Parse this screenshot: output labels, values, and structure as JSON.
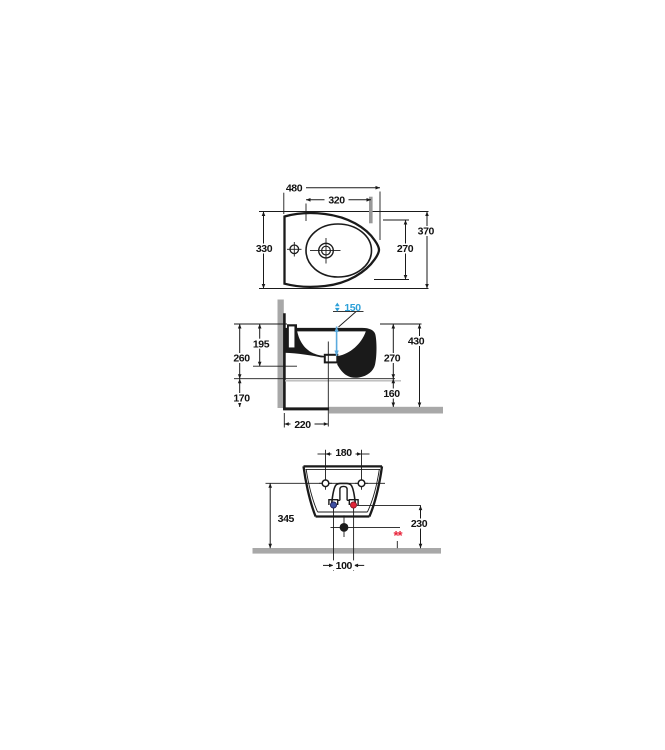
{
  "title": "Wall-hung bidet technical drawing (three views with dimensions in mm)",
  "colors": {
    "line": "#1a1a1a",
    "wall_floor_gray": "#a8a8a8",
    "plan_marker_gray": "#999999",
    "jet_text_blue": "#2da0d8",
    "jet_arrow_blue": "#5aaade",
    "cold_water_blue": "#3d4fa1",
    "hot_water_red": "#e02537",
    "note_red": "#e8233a"
  },
  "top_view": {
    "overall_length": "480",
    "bowl_length": "320",
    "overall_depth": "370",
    "bowl_width": "270",
    "rear_width": "330"
  },
  "side_view": {
    "jet_height": "150",
    "rim_to_underside": "195",
    "rim_to_belly": "260",
    "belly_to_floor": "170",
    "overall_height": "430",
    "front_height": "270",
    "front_clearance": "160",
    "drain_from_wall": "220"
  },
  "front_view": {
    "fixing_hole_spacing": "180",
    "fixing_height": "345",
    "supply_height": "230",
    "supply_spacing": "100",
    "note_marker": "**"
  }
}
